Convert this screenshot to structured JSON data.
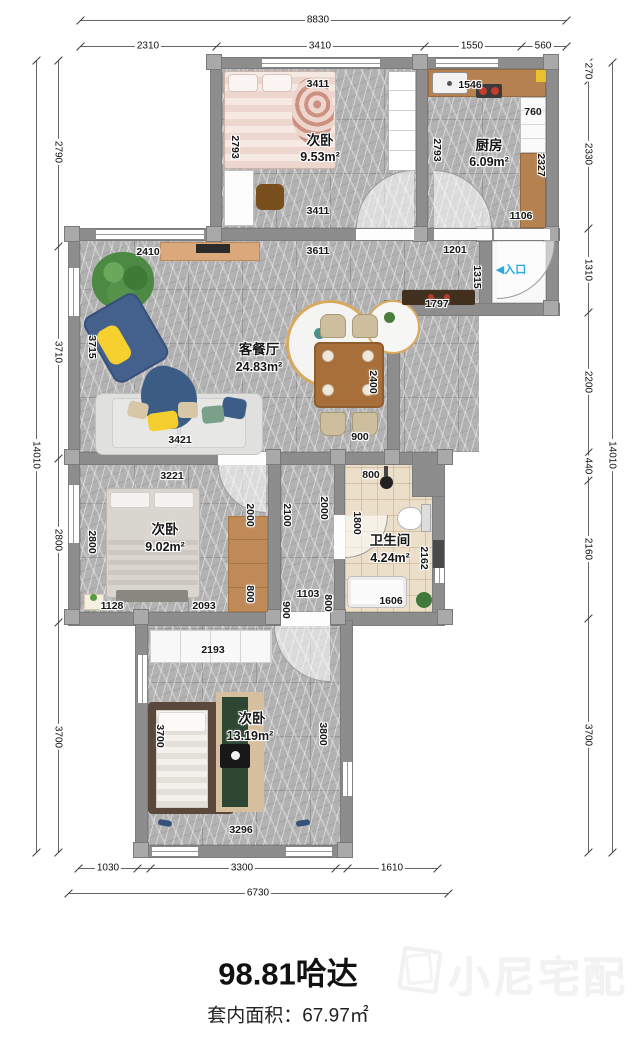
{
  "rooms": {
    "bed1": {
      "name": "次卧",
      "area": "9.53m²"
    },
    "kitchen": {
      "name": "厨房",
      "area": "6.09m²"
    },
    "living": {
      "name": "客餐厅",
      "area": "24.83m²"
    },
    "bed2": {
      "name": "次卧",
      "area": "9.02m²"
    },
    "bath": {
      "name": "卫生间",
      "area": "4.24m²"
    },
    "bed3": {
      "name": "次卧",
      "area": "13.19m²"
    }
  },
  "entry": {
    "arrow": "◀",
    "label": "入口"
  },
  "outer": {
    "top_total": "8830",
    "top_1": "2310",
    "top_2": "3410",
    "top_3": "1550",
    "top_4": "560",
    "left_total": "14010",
    "left_1": "2790",
    "left_2": "3710",
    "left_3": "2800",
    "left_4": "3700",
    "right_total": "14010",
    "right_1": "270",
    "right_2": "2330",
    "right_3": "1310",
    "right_4": "2200",
    "right_5": "440",
    "right_6": "2160",
    "right_7": "3700",
    "bottom_total": "6730",
    "bottom_1": "1030",
    "bottom_2": "3300",
    "bottom_3": "1610"
  },
  "inner": {
    "bed1_top": "3411",
    "bed1_left": "2793",
    "bed1_bottom": "3411",
    "kitchen_top": "1546",
    "kitchen_760": "760",
    "kitchen_left": "2793",
    "kitchen_right": "2327",
    "kitchen_bottom": "1106",
    "living_2410": "2410",
    "living_3611": "3611",
    "living_1201": "1201",
    "living_1315": "1315",
    "living_1797": "1797",
    "living_3715": "3715",
    "living_2400": "2400",
    "living_900": "900",
    "living_3421": "3421",
    "bed2_top": "3221",
    "bed2_left": "2800",
    "bed2_2000": "2000",
    "bed2_800": "800",
    "bed2_1128": "1128",
    "bed2_2093": "2093",
    "hall_2100": "2100",
    "hall_2000": "2000",
    "hall_1103": "1103",
    "hall_900": "900",
    "hall_800": "800",
    "bath_800": "800",
    "bath_1800": "1800",
    "bath_2162": "2162",
    "bath_1606": "1606",
    "bed3_2193": "2193",
    "bed3_3700": "3700",
    "bed3_3800": "3800",
    "bed3_3296": "3296"
  },
  "footer": {
    "title": "98.81哈达",
    "area_line": "套内面积：67.97㎡",
    "watermark": "小尼宅配"
  }
}
